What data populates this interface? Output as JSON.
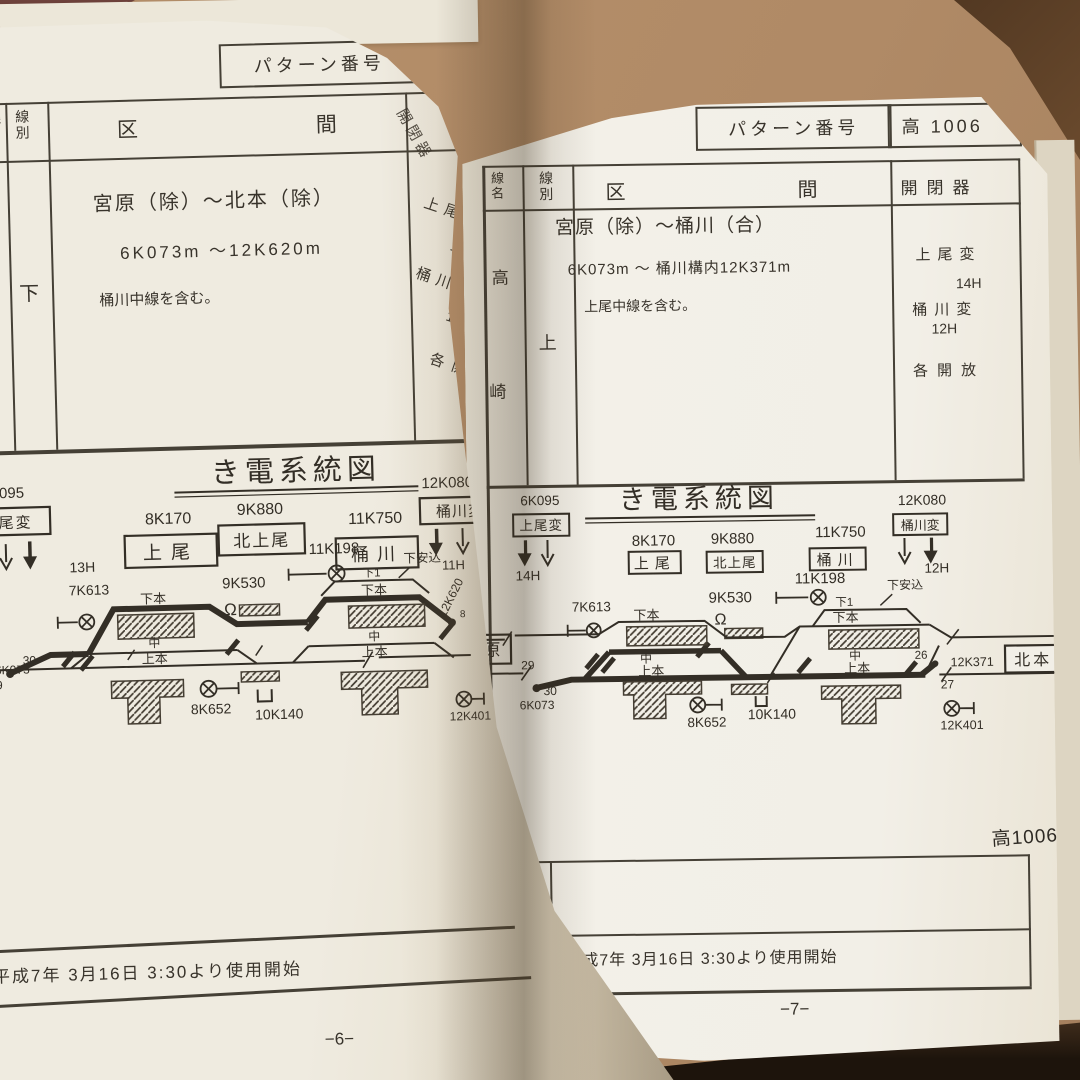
{
  "left_page": {
    "pattern": {
      "label": "パターン番号",
      "value": "高 10"
    },
    "table": {
      "col_line_name": "線名",
      "col_line_type": "線別",
      "col_section": "区間",
      "col_switch": "開閉器",
      "line_type": "下",
      "section_title": "宮原（除）～北本（除）",
      "section_range": "6K073m ～12K620m",
      "section_note": "桶川中線を含む。",
      "switch_frag1": "上尾変",
      "switch_frag2": "13",
      "switch_frag3": "桶川変",
      "switch_frag4": "11",
      "switch_frag5": "各開"
    },
    "diagram": {
      "title": "き電系統図",
      "sub_left_km": "6K095",
      "sub_left_name": "上尾変",
      "sub_left_hours": "13H",
      "st1_km": "8K170",
      "st1_name": "上尾",
      "st2_km": "9K880",
      "st2_name": "北上尾",
      "st3_km": "11K750",
      "st3_name": "桶川",
      "sub_right_km": "12K080",
      "sub_right_name": "桶川変",
      "sub_right_hours": "11H",
      "sw_a_km": "7K613",
      "sw_b_km": "11K198",
      "neutral_km": "9K530",
      "shed_label": "下安込",
      "omega": "Ω",
      "u_mark": "U",
      "lbl_down_main": "下本",
      "lbl_middle": "中",
      "lbl_up_main": "上本",
      "lbl_down1": "下1",
      "km_start": "6K073",
      "num_29": "29",
      "num_30": "30",
      "num_8": "8",
      "sw_c_km": "8K652",
      "u_km": "10K140",
      "sw_d_km": "12K401",
      "km_end": "12K620"
    },
    "footer_date": "平成7年 3月16日 3:30より使用開始",
    "page_number": "−6−"
  },
  "right_page": {
    "pattern": {
      "label": "パターン番号",
      "value": "高 1006"
    },
    "table": {
      "col_line_name": "線名",
      "col_line_type": "線別",
      "col_section": "区間",
      "col_switch": "開閉器",
      "line_name_char1": "高",
      "line_name_char2": "崎",
      "line_type": "上",
      "section_title": "宮原（除）～桶川（合）",
      "section_range": "6K073m ～ 桶川構内12K371m",
      "section_note": "上尾中線を含む。",
      "switch_line1": "上尾変",
      "switch_line2": "14H",
      "switch_line3": "桶川変",
      "switch_line4": "12H",
      "switch_line5": "各開放"
    },
    "diagram": {
      "title": "き電系統図",
      "sub_left_km": "6K095",
      "sub_left_name": "上尾変",
      "sub_left_hours": "14H",
      "st1_km": "8K170",
      "st1_name": "上尾",
      "st2_km": "9K880",
      "st2_name": "北上尾",
      "st3_km": "11K750",
      "st3_name": "桶川",
      "sub_right_km": "12K080",
      "sub_right_name": "桶川変",
      "sub_right_hours": "12H",
      "sw_a_km": "7K613",
      "sw_b_km": "11K198",
      "neutral_km": "9K530",
      "shed_label": "下安込",
      "omega": "Ω",
      "u_mark": "U",
      "lbl_down_main": "下本",
      "lbl_middle": "中",
      "lbl_up_main": "上本",
      "lbl_down1": "下1",
      "km_start": "6K073",
      "num_29": "29",
      "num_30": "30",
      "num_26": "26",
      "num_27": "27",
      "sw_c_km": "8K652",
      "u_km": "10K140",
      "sw_d_km": "12K401",
      "km_end": "12K371",
      "box_left": "原",
      "box_right": "北本",
      "note": "高1006"
    },
    "rows": {
      "remarks_label": "記 事",
      "date_label": "改正年月日",
      "date_value": "平成7年 3月16日 3:30より使用開始"
    },
    "page_number": "−7−"
  }
}
